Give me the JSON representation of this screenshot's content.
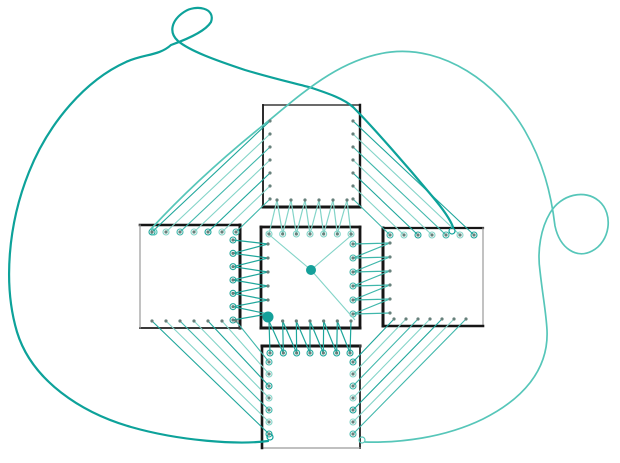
{
  "canvas": {
    "w": 620,
    "h": 463,
    "bg": "#ffffff"
  },
  "palette": {
    "bg": "#ffffff",
    "border_dark": "#161616",
    "border_mid": "#3a3a3a",
    "border_light": "#9a9a9a",
    "dot": "#66807b",
    "big_dot": "#14a09a",
    "curve_dark": "#0da29a",
    "curve_light": "#56c6b9",
    "line_light": "#83d4c8",
    "line_mid": "#3fb7ab",
    "line_dark": "#1ea69b"
  },
  "bundle_cycle": [
    "line_dark",
    "line_light",
    "line_mid",
    "line_light"
  ],
  "squares": [
    {
      "id": "top",
      "x1": 263,
      "y1": 105,
      "x2": 360,
      "y2": 207,
      "edges": [
        [
          "top",
          1.5,
          "border_mid"
        ],
        [
          "right",
          2.4,
          "border_dark"
        ],
        [
          "bottom",
          3,
          "border_dark"
        ],
        [
          "left",
          1.8,
          "border_dark"
        ]
      ]
    },
    {
      "id": "left",
      "x1": 140,
      "y1": 225,
      "x2": 240,
      "y2": 328,
      "edges": [
        [
          "top",
          2.6,
          "border_dark"
        ],
        [
          "right",
          3,
          "border_dark"
        ],
        [
          "bottom",
          2,
          "border_mid"
        ],
        [
          "left",
          1.2,
          "border_light"
        ]
      ]
    },
    {
      "id": "center",
      "x1": 261,
      "y1": 227,
      "x2": 360,
      "y2": 328,
      "edges": [
        [
          "top",
          2.8,
          "border_dark"
        ],
        [
          "right",
          2.8,
          "border_dark"
        ],
        [
          "bottom",
          3,
          "border_dark"
        ],
        [
          "left",
          2.8,
          "border_dark"
        ]
      ]
    },
    {
      "id": "right",
      "x1": 383,
      "y1": 228,
      "x2": 483,
      "y2": 326,
      "edges": [
        [
          "top",
          2.2,
          "border_dark"
        ],
        [
          "right",
          1.2,
          "border_light"
        ],
        [
          "bottom",
          2.6,
          "border_dark"
        ],
        [
          "left",
          3,
          "border_dark"
        ]
      ]
    },
    {
      "id": "bottom",
      "x1": 262,
      "y1": 346,
      "x2": 360,
      "y2": 448,
      "edges": [
        [
          "top",
          3,
          "border_dark"
        ],
        [
          "right",
          2,
          "border_mid"
        ],
        [
          "bottom",
          1.2,
          "border_light"
        ],
        [
          "left",
          2.6,
          "border_dark"
        ]
      ]
    }
  ],
  "dot_rows": [
    {
      "id": "top.left",
      "axis": "v",
      "x": 270,
      "from": 121,
      "to": 199,
      "n": 7
    },
    {
      "id": "top.right",
      "axis": "v",
      "x": 353,
      "from": 121,
      "to": 199,
      "n": 7
    },
    {
      "id": "top.bottom",
      "axis": "h",
      "y": 200,
      "from": 277,
      "to": 347,
      "n": 6
    },
    {
      "id": "left.top",
      "axis": "h",
      "y": 232,
      "from": 152,
      "to": 236,
      "n": 7
    },
    {
      "id": "left.right",
      "axis": "v",
      "x": 233,
      "from": 240,
      "to": 320,
      "n": 7
    },
    {
      "id": "left.bottom",
      "axis": "h",
      "y": 321,
      "from": 152,
      "to": 236,
      "n": 7
    },
    {
      "id": "center.top",
      "axis": "h",
      "y": 234,
      "from": 269,
      "to": 351,
      "n": 7
    },
    {
      "id": "center.left",
      "axis": "v",
      "x": 268,
      "from": 244,
      "to": 314,
      "n": 6
    },
    {
      "id": "center.right",
      "axis": "v",
      "x": 353,
      "from": 244,
      "to": 314,
      "n": 6
    },
    {
      "id": "center.bottom",
      "axis": "h",
      "y": 321,
      "from": 269,
      "to": 351,
      "n": 7
    },
    {
      "id": "right.top",
      "axis": "h",
      "y": 235,
      "from": 390,
      "to": 474,
      "n": 7
    },
    {
      "id": "right.left",
      "axis": "v",
      "x": 390,
      "from": 243,
      "to": 313,
      "n": 6
    },
    {
      "id": "right.bottom",
      "axis": "h",
      "y": 319,
      "from": 394,
      "to": 466,
      "n": 7
    },
    {
      "id": "bottom.top",
      "axis": "h",
      "y": 353,
      "from": 270,
      "to": 350,
      "n": 7
    },
    {
      "id": "bottom.left",
      "axis": "v",
      "x": 269,
      "from": 362,
      "to": 434,
      "n": 7
    },
    {
      "id": "bottom.right",
      "axis": "v",
      "x": 353,
      "from": 362,
      "to": 434,
      "n": 7
    }
  ],
  "bundles": [
    {
      "id": "top-to-left",
      "from": "top.left",
      "to": "left.top",
      "map": "same"
    },
    {
      "id": "top-to-right",
      "from": "top.right",
      "to": "right.top",
      "map": "reverse"
    },
    {
      "id": "left-to-bottom",
      "from": "left.bottom",
      "to": "bottom.left",
      "map": "reverse"
    },
    {
      "id": "right-to-bottom",
      "from": "right.bottom",
      "to": "bottom.right",
      "map": "same"
    }
  ],
  "stitches": [
    {
      "id": "gap-top",
      "a": "top.bottom",
      "b": "center.top",
      "color": "line_light"
    },
    {
      "id": "gap-bottom",
      "a": "center.bottom",
      "b": "bottom.top",
      "color": "line_dark"
    },
    {
      "id": "gap-left",
      "a": "center.left",
      "b": "left.right",
      "color": "line_dark"
    },
    {
      "id": "gap-right",
      "a": "right.left",
      "b": "center.right",
      "color": "line_mid"
    }
  ],
  "center_graph": {
    "lines": [
      [
        266,
        232,
        311,
        270
      ],
      [
        311,
        270,
        353,
        234
      ],
      [
        311,
        270,
        355,
        320
      ]
    ],
    "line_color": "line_light",
    "big_dots": [
      [
        311,
        270,
        5
      ],
      [
        268,
        317,
        5.5
      ]
    ]
  },
  "free_curves": [
    {
      "id": "dark-loop-curve",
      "color": "curve_dark",
      "width": 2.2,
      "path": "M 268 441 C 238 445 180 441 131 427 C 82 413 32 381 17 332 C 3 285 8 224 29 172 C 49 122 86 80 126 62 C 143 54 159 56 171 45 C 185 40 205 32 211 22 C 216 8 196 4 184 12 C 172 20 168 32 178 41 C 190 51 215 60 245 70 C 275 79 298 84 312 88 C 330 94 344 99 353 107 C 372 126 407 166 432 196 C 443 209 450 219 453 227",
      "hooks": [
        [
          270,
          437
        ],
        [
          452,
          231
        ]
      ]
    },
    {
      "id": "light-loop-curve",
      "color": "curve_light",
      "width": 1.7,
      "path": "M 151 229 C 186 191 224 157 261 127 C 297 98 338 58 391 52 C 443 46 497 82 525 131 C 543 162 551 193 555 226 C 560 249 577 259 592 251 C 610 242 614 214 599 201 C 585 189 561 194 550 213 C 541 228 537 250 540 271 C 543 298 546 312 547 330 C 549 371 521 400 483 419 C 444 438 399 443 365 442",
      "hooks": [
        [
          154,
          232
        ],
        [
          362,
          440
        ]
      ]
    }
  ],
  "dot_radius": 1.6,
  "hook_radius": 3,
  "bundle_width": 1.1,
  "stitch_width": 1.2
}
